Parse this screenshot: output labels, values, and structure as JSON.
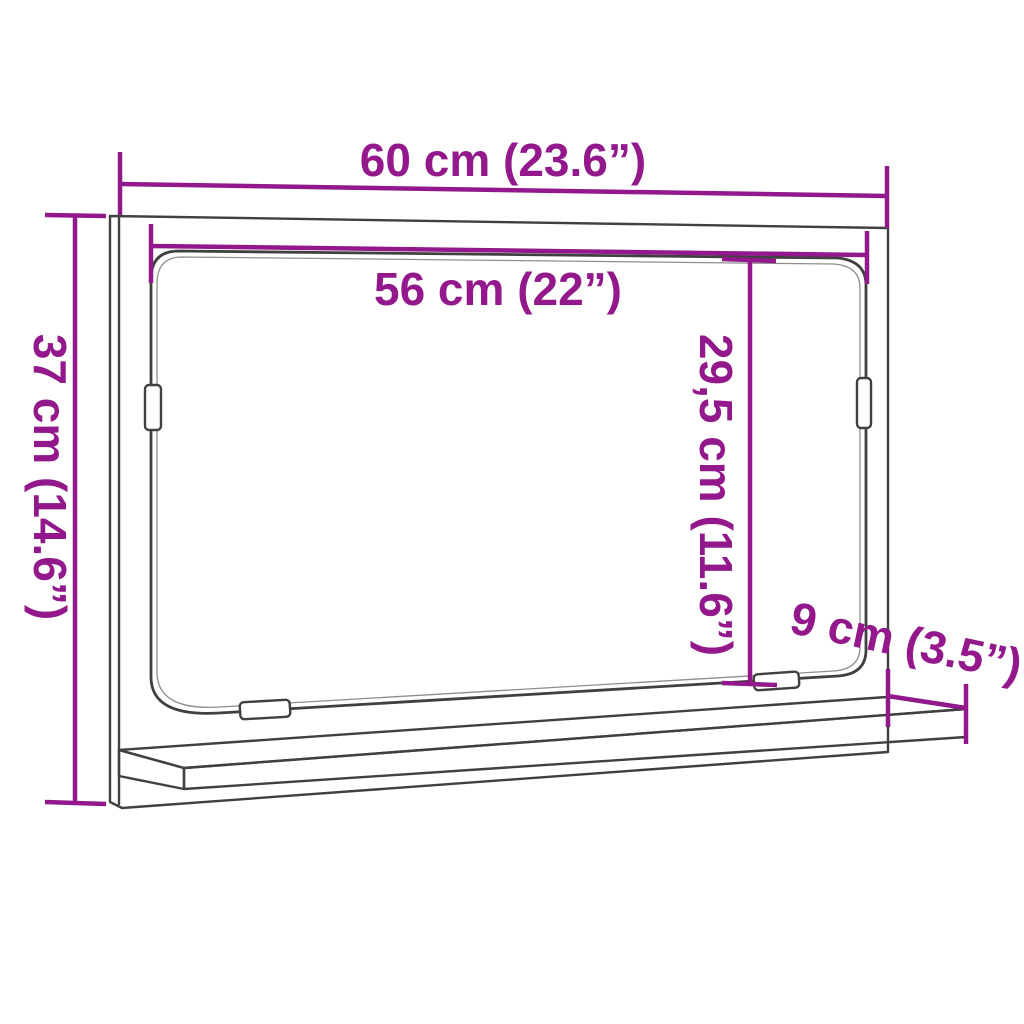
{
  "diagram": {
    "title": "mirror-cabinet-with-shelf-dimension-drawing"
  },
  "dimensions": {
    "width_top": "60 cm (23.6”)",
    "width_inner": "56 cm (22”)",
    "height_left": "37 cm (14.6”)",
    "height_inner": "29,5 cm (11.6”)",
    "shelf_depth": "9 cm (3.5”)"
  },
  "colors": {
    "dimension": "#93188b",
    "outline": "#404040",
    "outline_light": "#8e8e8e",
    "background": "#ffffff"
  }
}
